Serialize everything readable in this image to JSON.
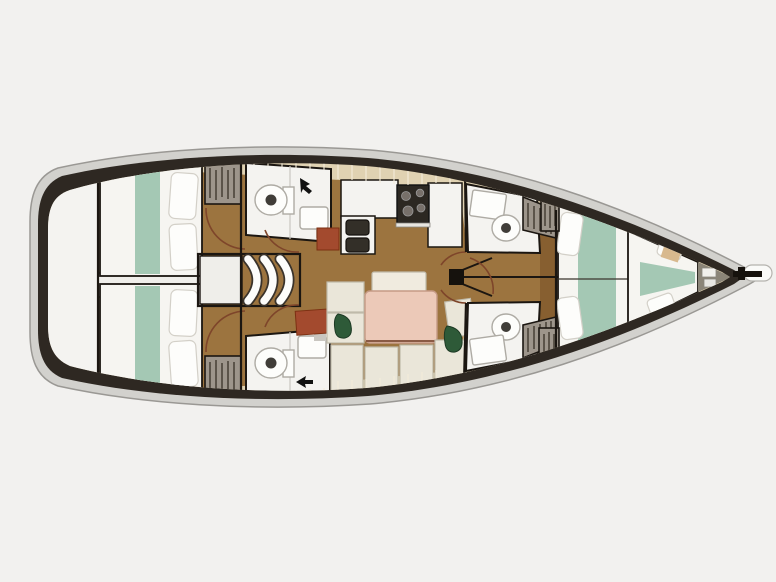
{
  "figure": {
    "kind": "sailing-yacht-interior-floor-plan",
    "orientation": "bow-right",
    "rooms": [
      {
        "name": "swim-platform-transom"
      },
      {
        "name": "aft-cabin-port",
        "features": [
          "double-berth",
          "teal-runner",
          "pillows",
          "hanging-locker"
        ]
      },
      {
        "name": "aft-cabin-starboard",
        "features": [
          "double-berth",
          "teal-runner",
          "pillows",
          "hanging-locker"
        ]
      },
      {
        "name": "aft-corridor-engine-access"
      },
      {
        "name": "companionway-steps"
      },
      {
        "name": "head-aft-port",
        "features": [
          "toilet",
          "sink"
        ]
      },
      {
        "name": "head-aft-starboard",
        "features": [
          "toilet",
          "sink"
        ]
      },
      {
        "name": "galley",
        "features": [
          "stove",
          "double-sink",
          "counter"
        ]
      },
      {
        "name": "salon",
        "features": [
          "table",
          "settee-cushions",
          "plants"
        ]
      },
      {
        "name": "mast-with-rigging"
      },
      {
        "name": "head-fwd-port",
        "features": [
          "toilet",
          "sink",
          "hanging-locker"
        ]
      },
      {
        "name": "head-fwd-starboard",
        "features": [
          "toilet",
          "sink",
          "hanging-locker"
        ]
      },
      {
        "name": "forward-cabin",
        "features": [
          "v-berth",
          "teal-runner",
          "pillows",
          "forward-insert"
        ]
      },
      {
        "name": "anchor-locker"
      },
      {
        "name": "bowsprit"
      }
    ]
  },
  "colors": {
    "background": "#f2f1ef",
    "hull_rim": "#d2d1cd",
    "hull_rim_edge": "#9a9894",
    "hull_dark": "#2e2822",
    "tile": "#e0d2b2",
    "grout": "#f3ecd9",
    "wood": "#9c743f",
    "wood_deep": "#875f30",
    "white_room": "#f4f3f0",
    "bed_white": "#f6f5f1",
    "pillow": "#fdfdfb",
    "pillow_edge": "#d3d0c8",
    "teal": "#a4c8b4",
    "locker": "#9d958b",
    "locker_hatch": "#4b443a",
    "outline": "#1b1611",
    "table_pink": "#ecc9b8",
    "table_edge": "#c59a85",
    "cushion": "#eae6d9",
    "cushion_edge": "#bfbaaa",
    "bench_light": "#f0ebdf",
    "plant": "#2e5a38",
    "stove": "#2c2822",
    "burner": "#77706a",
    "sink_dark": "#332f28",
    "red_cab": "#a34a2e",
    "door_arc": "#7e452a",
    "steel": "#8b8578",
    "corridor": "#efeeea",
    "fixture_edge": "#aeaba4"
  }
}
